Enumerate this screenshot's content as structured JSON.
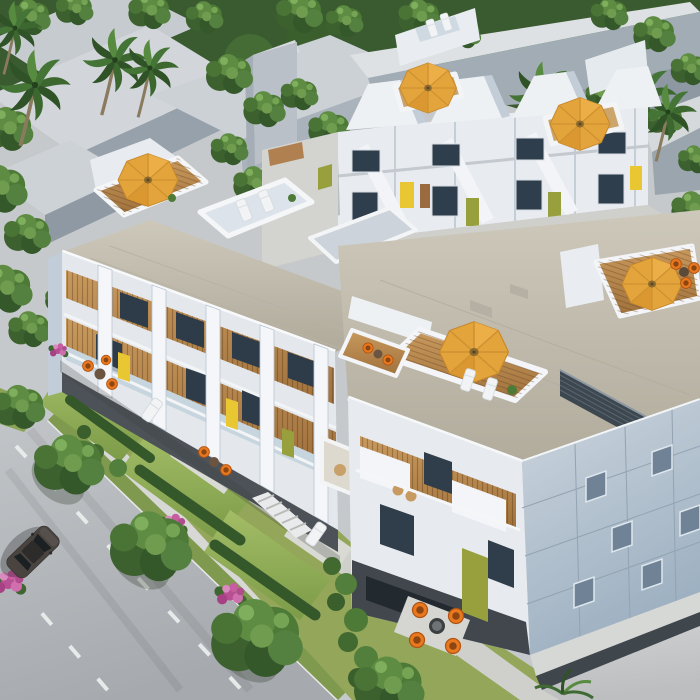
{
  "image": {
    "type": "architectural-aerial-rendering",
    "subject": "Aerial 3D visualization of a modern white townhome development with rooftop decks, landscaped courtyards and a tree-lined street",
    "time_of_day": "daytime",
    "visible_text": "none"
  },
  "scene": {
    "background": {
      "context_buildings": "flat-roofed gray blocks",
      "vegetation": "dense leafy tree canopy",
      "palm_tree_count": 7
    },
    "buildings": {
      "left_block": "3-story white units, wood-slat balcony band, yellow accents, concrete roof with railed terraces",
      "rear_row": "white gabled townhouses with olive and yellow entry accents and exterior stairs",
      "right_block": "white SW facade with wood balconies and olive panel; blue-gray panelized SE wall with square windows; concrete roof with wood-deck terraces and dark louver screen"
    },
    "rooftop_umbrellas": {
      "count": 5,
      "color": "orange"
    },
    "street": {
      "position": "bottom-left",
      "lane_marking": "white dashed lines",
      "parked_car_count": 1,
      "car_color": "dark gray"
    },
    "gardens": {
      "features": [
        "lawns",
        "hedges",
        "pink bougainvillea",
        "paved patios",
        "garden steps",
        "courtyard path"
      ],
      "furniture": [
        "orange bucket chairs",
        "round tables",
        "white sun loungers",
        "wicker chairs"
      ]
    }
  },
  "palette": {
    "white_sunlit": "#f4f6f8",
    "white_shade": "#c7d2de",
    "concrete_roof": "#c2bcae",
    "wood_deck": "#c2935b",
    "umbrella_orange": "#e4a43c",
    "chair_orange": "#e8791f",
    "accent_yellow": "#e9c733",
    "accent_olive": "#97a03c",
    "glass_dark": "#33414f",
    "foliage_dark": "#2e4d27",
    "foliage_mid": "#4e7a38",
    "foliage_light": "#7ba355",
    "lawn_green": "#8fae56",
    "flower_pink": "#c0579a",
    "asphalt_gray": "#b0b4b8",
    "context_gray": "#9aa5af",
    "blue_wall": "#b6c3d1",
    "car_gray": "#46413e"
  }
}
